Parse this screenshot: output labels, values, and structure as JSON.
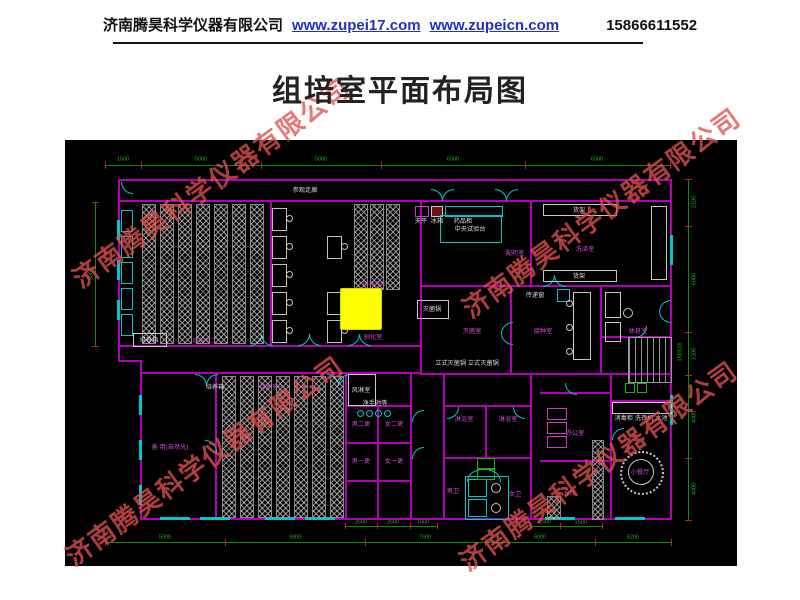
{
  "header": {
    "company": "济南腾昊科学仪器有限公司",
    "link1": "www.zupei17.com",
    "link2": "www.zupeicn.com",
    "phone": "15866611552"
  },
  "title": "组培室平面布局图",
  "watermark": {
    "text": "济南腾昊科学仪器有限公司"
  },
  "plan": {
    "room_labels": [
      "培养室二",
      "培养室三",
      "驯化室",
      "培养室一",
      "备 用(自然光)",
      "配药室",
      "洗涤室",
      "灭菌室",
      "接种室",
      "休息室",
      "男二更",
      "女二更",
      "男一更",
      "女一更",
      "淋浴室",
      "淋浴室",
      "男卫",
      "女卫",
      "办公室",
      "仓库",
      "小餐厅"
    ],
    "equipment_labels": [
      "参观走廊",
      "培养箱",
      "培养箱",
      "中央试验台",
      "天平",
      "冰箱",
      "药品柜",
      "货架",
      "货架",
      "灭菌锅",
      "立式灭菌锅 立式灭菌锅",
      "风淋室",
      "净手池等",
      "传递窗",
      "消毒柜 洗衣机 水池"
    ],
    "dims": {
      "top": [
        "1500",
        "5000",
        "5000",
        "6000",
        "6000"
      ],
      "left": [
        "5000"
      ],
      "right": [
        "2100",
        "6000",
        "1500",
        "4000",
        "4000"
      ],
      "stair_note": "150X16",
      "bottom_inner": [
        "2500",
        "2500",
        "1500",
        "1500",
        "2500"
      ],
      "bottom_outer": [
        "5000",
        "9000",
        "7600",
        "6000",
        "5200"
      ]
    },
    "colors": {
      "wall": "#b400b4",
      "opening": "#00c8c8",
      "dimension": "#18a018",
      "tick": "#cc2020",
      "room_label": "#d24bd2",
      "equipment_label": "#d8d8d8",
      "highlight": "#ffff00",
      "background": "#000000",
      "watermark": "#e05050",
      "link": "#2230c8"
    }
  }
}
